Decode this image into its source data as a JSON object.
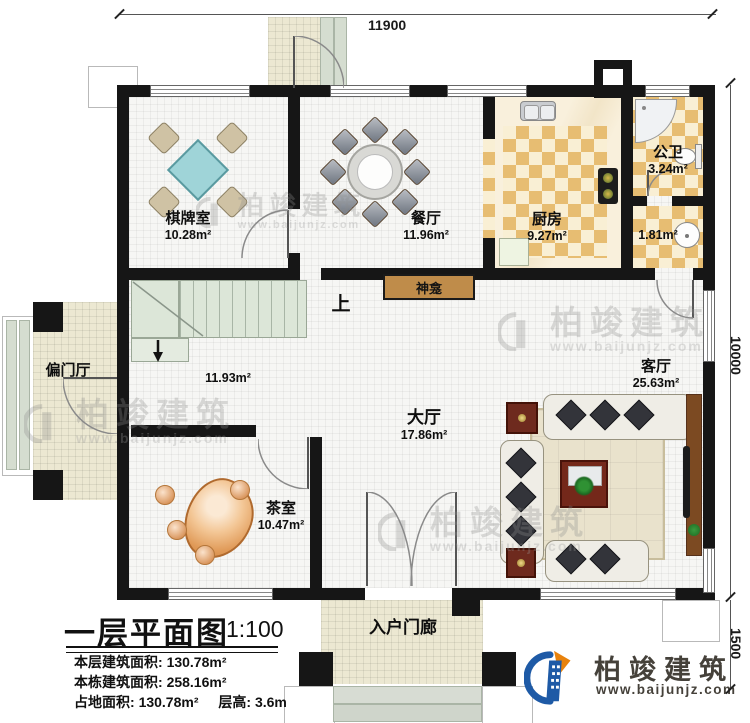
{
  "dimensions": {
    "top": "11900",
    "right_main": "10000",
    "right_lower": "1500"
  },
  "rooms": {
    "chess": {
      "name": "棋牌室",
      "area": "10.28m²"
    },
    "dining": {
      "name": "餐厅",
      "area": "11.96m²"
    },
    "kitchen": {
      "name": "厨房",
      "area": "9.27m²"
    },
    "bathroom": {
      "name": "公卫",
      "area": "3.24m²"
    },
    "washroom": {
      "area": "1.81m²"
    },
    "stair_hall": {
      "area": "11.93m²"
    },
    "hall": {
      "name": "大厅",
      "area": "17.86m²"
    },
    "living": {
      "name": "客厅",
      "area": "25.63m²"
    },
    "tea": {
      "name": "茶室",
      "area": "10.47m²"
    },
    "side_porch": {
      "name": "偏门厅"
    },
    "entry_porch": {
      "name": "入户门廊"
    },
    "shrine": {
      "name": "神龛"
    },
    "stairs": {
      "up": "上"
    }
  },
  "titleblock": {
    "title": "一层平面图",
    "scale": "1:100",
    "stats": [
      {
        "label": "本层建筑面积:",
        "value": "130.78m²"
      },
      {
        "label": "本栋建筑面积:",
        "value": "258.16m²"
      },
      {
        "label": "占地面积:",
        "value": "130.78m²"
      },
      {
        "label": "层高:",
        "value": "3.6m"
      }
    ]
  },
  "branding": {
    "company": "柏竣建筑",
    "website": "www.baijunjz.com"
  },
  "watermark": {
    "company": "柏竣建筑",
    "website": "www.baijunjz.com"
  },
  "colors": {
    "wall": "#161616",
    "logo_blue": "#1e5aa6",
    "logo_orange": "#e8820c",
    "shrine": "#bf8c4a"
  }
}
